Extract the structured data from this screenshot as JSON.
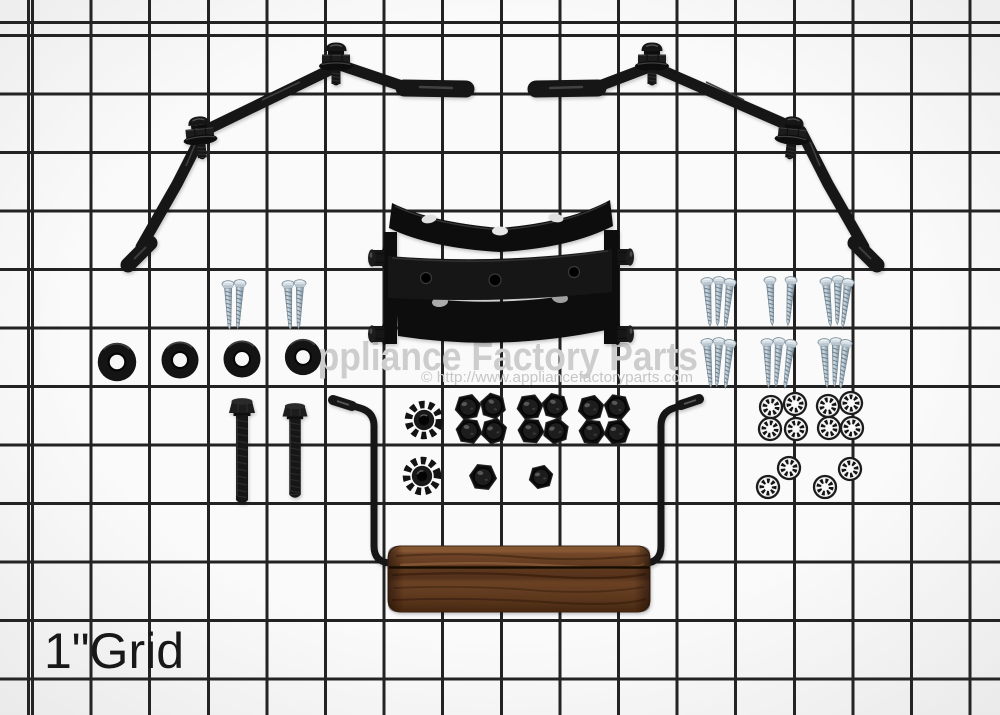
{
  "watermark": {
    "title": "Appliance Factory Parts",
    "url_line": "© http://www.appliancefactoryparts.com"
  },
  "grid_label": "1\"Grid",
  "colors": {
    "bg": "#fafafa",
    "grid-line": "#222222",
    "part-black": "#141414",
    "zinc": "#bcc9d3",
    "wood": "#5f391f",
    "watermark": "#cdcdcd",
    "watermark-url": "#c6c6c6",
    "label": "#161616"
  },
  "photo_contents": {
    "description_of_items": "hardware parts kit laid on 1-inch wire grid",
    "left_support_bracket": {
      "material": "black metal",
      "carriage_bolt_assemblies": 2
    },
    "right_support_bracket": {
      "material": "black metal",
      "carriage_bolt_assemblies": 2
    },
    "center_bracket_assembly": {
      "material": "black metal",
      "bars": 3,
      "side_bolts": 4,
      "holes_visible": 8
    },
    "machine_screws_left": 4,
    "machine_screws_right": 17,
    "flat_washers_black": 4,
    "hex_bolts_black": 2,
    "keps_star_nuts_black": 2,
    "acorn_nut_clusters": 3,
    "acorn_nuts_total": 14,
    "star_lock_washers_silver": 12,
    "handle": {
      "grip_material": "wood",
      "rod": "black metal wire",
      "rod_tips": 2
    }
  }
}
